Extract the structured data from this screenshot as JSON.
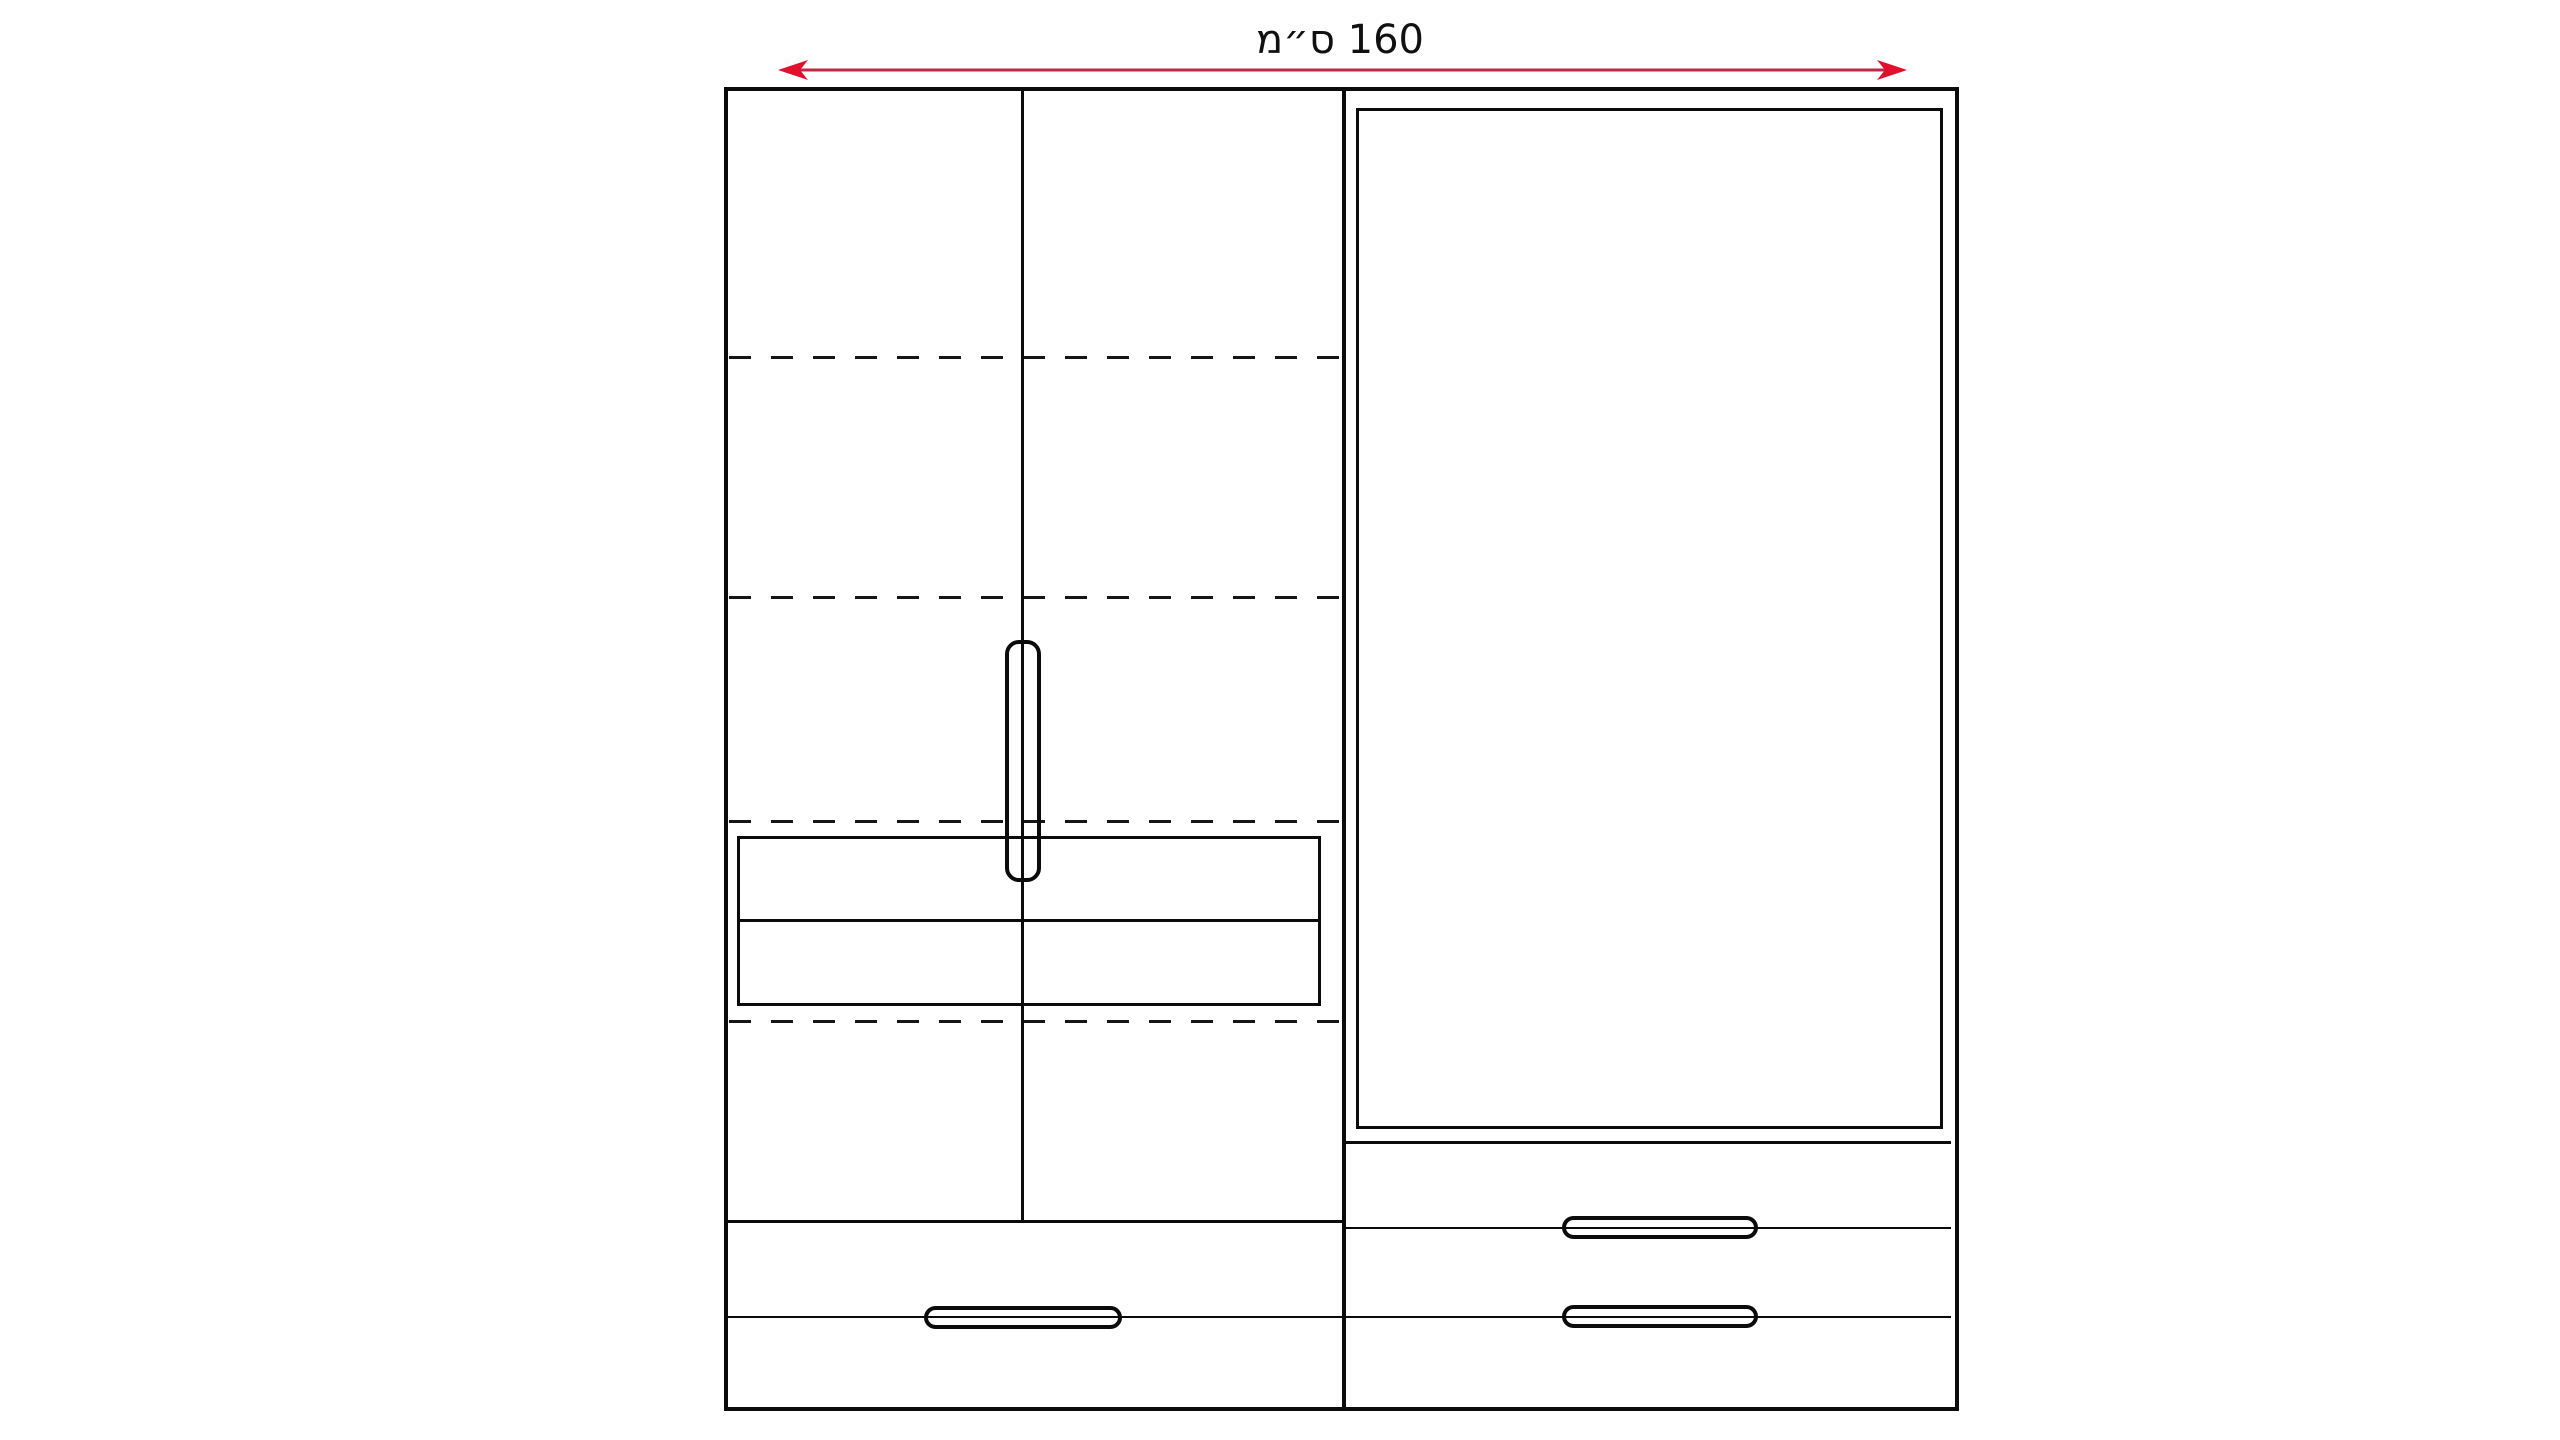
{
  "diagram": {
    "type": "wardrobe-front-elevation-drawing",
    "dimension": {
      "label": "160 ס״מ",
      "value": "160",
      "unit": "ס״מ"
    },
    "colors": {
      "arrow_line": "#c22845",
      "arrowhead": "#e0112d",
      "outline": "#0b0b0b"
    },
    "parts": {
      "left_section": "double doors with vertical handle, dashed shelf lines, inner drawer box, two bottom drawers",
      "right_section": "large door panel with two bottom drawers and shelf line"
    }
  }
}
